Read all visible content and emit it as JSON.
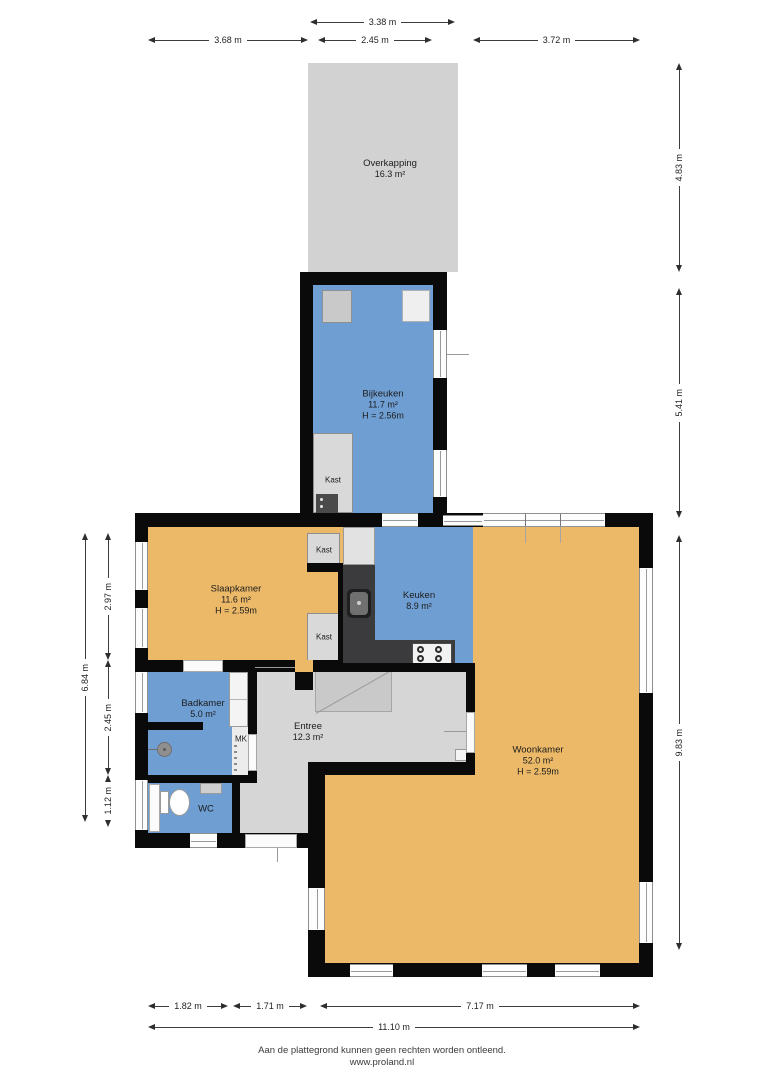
{
  "rooms": {
    "overkapping": {
      "name": "Overkapping",
      "area": "16.3 m²"
    },
    "bijkeuken": {
      "name": "Bijkeuken",
      "area": "11.7 m²",
      "ceiling": "H = 2.56m"
    },
    "kast_bijkeuken": {
      "name": "Kast"
    },
    "kast_boven": {
      "name": "Kast"
    },
    "kast_onder": {
      "name": "Kast"
    },
    "slaapkamer": {
      "name": "Slaapkamer",
      "area": "11.6 m²",
      "ceiling": "H = 2.59m"
    },
    "keuken": {
      "name": "Keuken",
      "area": "8.9 m²"
    },
    "badkamer": {
      "name": "Badkamer",
      "area": "5.0 m²"
    },
    "entree": {
      "name": "Entree",
      "area": "12.3 m²"
    },
    "wc": {
      "name": "WC"
    },
    "mk": {
      "name": "MK"
    },
    "woonkamer": {
      "name": "Woonkamer",
      "area": "52.0 m²",
      "ceiling": "H = 2.59m"
    }
  },
  "dims": {
    "top": [
      {
        "label": "3.38 m"
      },
      {
        "label": "3.68 m"
      },
      {
        "label": "2.45 m"
      },
      {
        "label": "3.72 m"
      }
    ],
    "right": [
      {
        "label": "4.83 m"
      },
      {
        "label": "5.41 m"
      },
      {
        "label": "9.83 m"
      }
    ],
    "left": [
      {
        "label": "6.84 m"
      },
      {
        "label": "2.97 m"
      },
      {
        "label": "2.45 m"
      },
      {
        "label": "1.12 m"
      }
    ],
    "bottom": [
      {
        "label": "1.82 m"
      },
      {
        "label": "1.71 m"
      },
      {
        "label": "7.17 m"
      },
      {
        "label": "11.10 m"
      }
    ]
  },
  "footer": {
    "disclaimer": "Aan de plattegrond kunnen geen rechten worden ontleend.",
    "website": "www.proland.nl"
  },
  "colors": {
    "room_dry": "#ecb968",
    "room_wet": "#6f9ed3",
    "floor_neutral": "#d6d6d6",
    "canopy": "#d2d2d2",
    "wall": "#0a0a0a",
    "counter": "#3b3b3d"
  }
}
